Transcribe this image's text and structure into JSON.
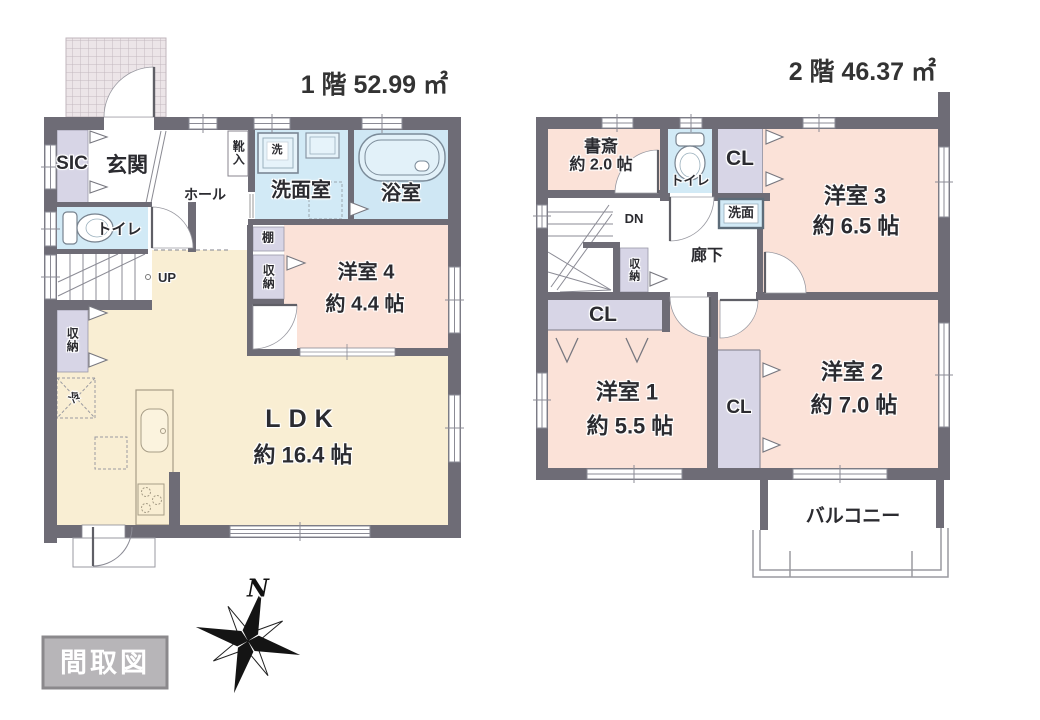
{
  "floor1": {
    "title": "1 階 52.99 ㎡",
    "rooms": {
      "sic": "SIC",
      "entrance": "玄関",
      "hall": "ホール",
      "shoe_box": "靴入",
      "washer": "洗",
      "washroom": "洗面室",
      "bathroom": "浴室",
      "toilet": "トイレ",
      "stairs_up": "UP",
      "shelf": "棚",
      "closet_mid": "収納",
      "room4": "洋室 4",
      "room4_size": "約 4.4 帖",
      "closet_left": "収納",
      "fridge": "冷",
      "ldk": "LDK",
      "ldk_size": "約 16.4 帖"
    }
  },
  "floor2": {
    "title": "2 階 46.37 ㎡",
    "rooms": {
      "study": "書斎",
      "study_size": "約 2.0 帖",
      "toilet": "トイレ",
      "closet_top": "CL",
      "basin": "洗面",
      "room3": "洋室 3",
      "room3_size": "約 6.5 帖",
      "stairs_down": "DN",
      "closet_stairs": "収納",
      "corridor": "廊下",
      "closet_bar": "CL",
      "room1": "洋室 1",
      "room1_size": "約 5.5 帖",
      "closet_mid": "CL",
      "room2": "洋室 2",
      "room2_size": "約 7.0 帖",
      "balcony": "バルコニー"
    }
  },
  "legend": {
    "label": "間取図"
  },
  "compass": {
    "north": "N"
  },
  "colors": {
    "wall": "#6e6c76",
    "room_pink": "#fbe2d8",
    "room_cream": "#f9eed3",
    "room_blue": "#d2eaf6",
    "closet_lavender": "#d7d5e6",
    "legend_gray": "#b7b5b8"
  }
}
